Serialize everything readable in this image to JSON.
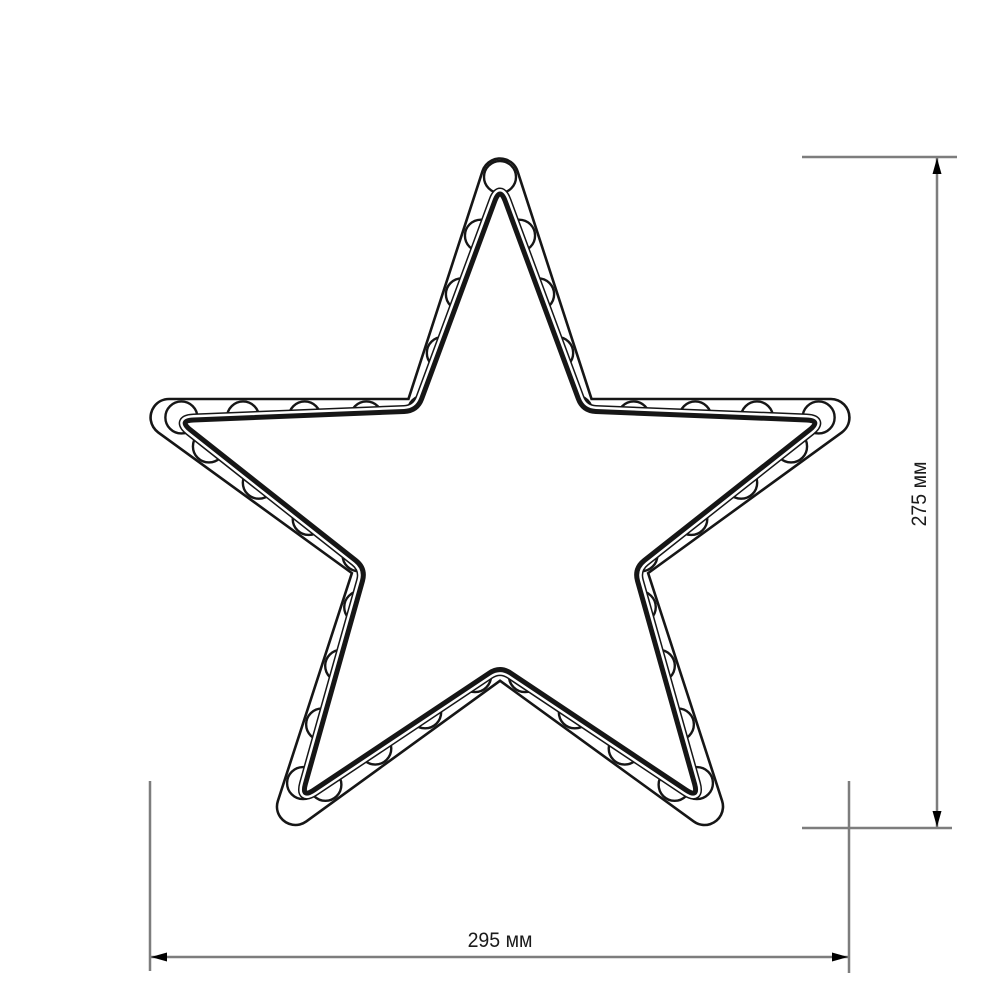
{
  "page": {
    "background_color": "#ffffff",
    "description": "Technical dimensional drawing of a five-pointed LED star decoration"
  },
  "diagram": {
    "type": "technical-drawing",
    "subject": "five-pointed star frame with round LED bulbs along its channel",
    "colors": {
      "outline": "#161616",
      "fill": "#ffffff",
      "dimension_line": "#7d7d7d",
      "arrow": "#000000",
      "text": "#1b1b1b"
    },
    "star": {
      "center_x": 500,
      "center_y": 525,
      "outer_radius": 348,
      "inner_radius_ratio": 0.382,
      "points": 5,
      "band_stroke_outer": 39.5,
      "band_stroke_inner_erase": 34.3,
      "contour_line_width": 2.6,
      "tube_tip_inset": 10,
      "tube_notch_offset": 8,
      "tube_corner_cut_tip": 15,
      "tube_corner_cut_notch": 13,
      "tube_outline_black": 13,
      "tube_outline_white": 10,
      "tube_core_width": 5
    },
    "leds": {
      "count": 41,
      "radius": 16,
      "stroke_width": 2.4
    },
    "dimensions": {
      "height": {
        "label": "275 мм",
        "value_mm": 275,
        "line": {
          "x": 937,
          "y1": 158,
          "y2": 827
        },
        "ext_top": {
          "x1": 802,
          "y1": 157,
          "x2": 957,
          "y2": 157
        },
        "ext_bottom": {
          "x1": 802,
          "y1": 828,
          "x2": 952,
          "y2": 828
        },
        "label_center": {
          "x": 920,
          "y": 494
        }
      },
      "width": {
        "label": "295 мм",
        "value_mm": 295,
        "line": {
          "y": 957,
          "x1": 151,
          "x2": 848
        },
        "ext_left": {
          "x": 150,
          "y1": 781,
          "y2": 971
        },
        "ext_right": {
          "x": 849,
          "y1": 781,
          "y2": 973
        },
        "label_center": {
          "x": 500,
          "y": 941
        }
      }
    }
  }
}
